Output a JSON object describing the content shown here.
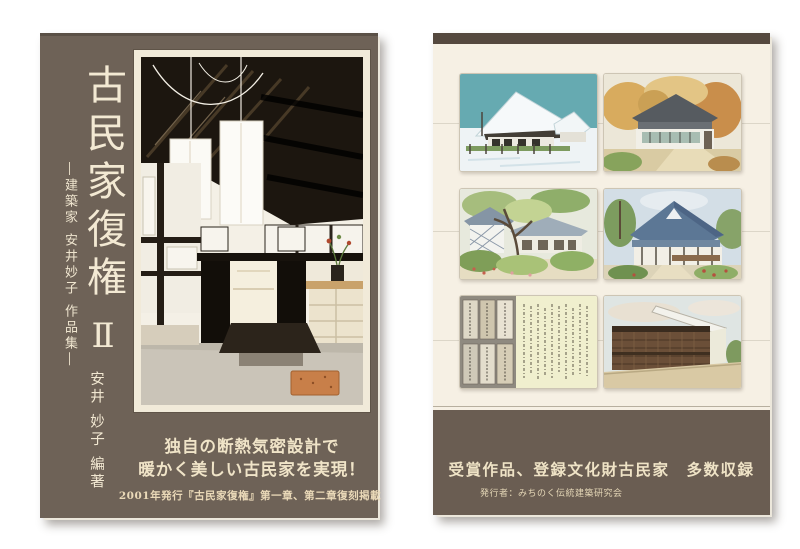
{
  "front_cover": {
    "title": "古民家復権",
    "volume": "Ⅱ",
    "subtitle": "―建築家 安井妙子 作品集―",
    "author": "安井 妙子 編著",
    "slogan_line1": "独自の断熱気密設計で",
    "slogan_line2": "暖かく美しい古民家を実現！",
    "reprint_note": "2001年発行『古民家復権』第一章、第二章復刻掲載",
    "photo": {
      "description": "吹き抜けの古民家内部と和紙行灯の写真"
    }
  },
  "back_cover": {
    "catch_line": "受賞作品、登録文化財古民家　多数収録",
    "publisher_line": "発行者：みちのく伝統建築研究会",
    "illustrations": [
      {
        "id": "snow-farmhouse",
        "description": "雪化粧の茅葺き古民家の水彩画"
      },
      {
        "id": "autumn-house",
        "description": "紅葉に囲まれた古民家の水彩画"
      },
      {
        "id": "garden-house",
        "description": "庭木と古民家の風景の水彩画"
      },
      {
        "id": "blue-roof-house",
        "description": "大屋根の古民家と庭の水彩画"
      },
      {
        "id": "old-documents",
        "description": "古文書と墨書の頁"
      },
      {
        "id": "storehouse",
        "description": "格子壁の蔵の水彩画"
      }
    ]
  },
  "colors": {
    "front_background": "#6e6257",
    "front_text": "#f3e9d3",
    "frame_cream": "#f1ead9",
    "back_background": "#f6f0e4",
    "back_top_bar": "#55493f",
    "back_band": "#6a5d52",
    "band_text": "#efe3c6"
  }
}
